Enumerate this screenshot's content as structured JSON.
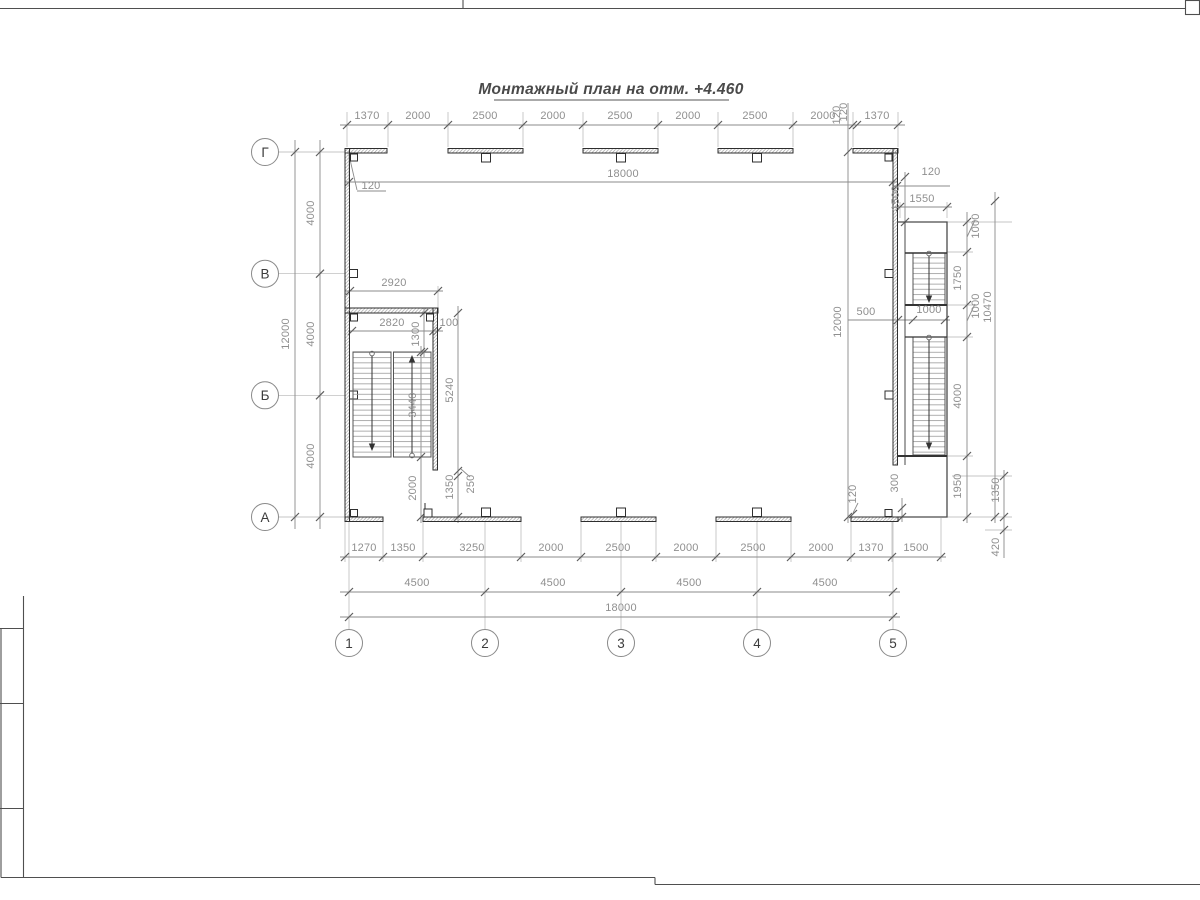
{
  "title": "Монтажный план на отм. +4.460",
  "axes": {
    "left": [
      {
        "label": "Г",
        "x": 265,
        "y": 152
      },
      {
        "label": "В",
        "x": 265,
        "y": 273.7
      },
      {
        "label": "Б",
        "x": 265,
        "y": 395.3
      },
      {
        "label": "А",
        "x": 265,
        "y": 517
      }
    ],
    "bottom": [
      {
        "label": "1",
        "x": 349,
        "y": 643
      },
      {
        "label": "2",
        "x": 485,
        "y": 643
      },
      {
        "label": "3",
        "x": 621,
        "y": 643
      },
      {
        "label": "4",
        "x": 757,
        "y": 643
      },
      {
        "label": "5",
        "x": 893,
        "y": 643
      }
    ]
  },
  "dimensions": {
    "top_chain": [
      "1370",
      "2000",
      "2500",
      "2000",
      "2500",
      "2000",
      "2500",
      "2000",
      "120",
      "1370"
    ],
    "top_overall": "18000",
    "left_chain": [
      "4000",
      "4000",
      "4000"
    ],
    "left_overall": "12000",
    "bottom_chain": [
      "1270",
      "1350",
      "3250",
      "2000",
      "2500",
      "2000",
      "2500",
      "2000",
      "1370",
      "1500"
    ],
    "bottom_spans": [
      "4500",
      "4500",
      "4500",
      "4500"
    ],
    "bottom_overall": "18000",
    "right_chain": [
      "1000",
      "1750",
      "1000",
      "4000",
      "1950"
    ],
    "right_overall": "10470",
    "wall_thickness": "120"
  },
  "labels": [
    {
      "t": "1370",
      "x": 367,
      "y": 119
    },
    {
      "t": "2000",
      "x": 418,
      "y": 119
    },
    {
      "t": "2500",
      "x": 485,
      "y": 119
    },
    {
      "t": "2000",
      "x": 553,
      "y": 119
    },
    {
      "t": "2500",
      "x": 620,
      "y": 119
    },
    {
      "t": "2000",
      "x": 688,
      "y": 119
    },
    {
      "t": "2500",
      "x": 755,
      "y": 119
    },
    {
      "t": "2000",
      "x": 823,
      "y": 119
    },
    {
      "t": "120",
      "x": 847,
      "y": 112,
      "r": -90
    },
    {
      "t": "1370",
      "x": 877,
      "y": 119
    },
    {
      "t": "18000",
      "x": 623,
      "y": 177
    },
    {
      "t": "120",
      "x": 371,
      "y": 189
    },
    {
      "t": "12000",
      "x": 289,
      "y": 334,
      "r": -90
    },
    {
      "t": "4000",
      "x": 314,
      "y": 213,
      "r": -90
    },
    {
      "t": "4000",
      "x": 314,
      "y": 334,
      "r": -90
    },
    {
      "t": "4000",
      "x": 314,
      "y": 456,
      "r": -90
    },
    {
      "t": "2920",
      "x": 394,
      "y": 286
    },
    {
      "t": "2820",
      "x": 392,
      "y": 326
    },
    {
      "t": "100",
      "x": 449,
      "y": 326
    },
    {
      "t": "1300",
      "x": 419,
      "y": 334,
      "r": -90
    },
    {
      "t": "3440",
      "x": 416,
      "y": 405,
      "r": -90
    },
    {
      "t": "5240",
      "x": 453,
      "y": 390,
      "r": -90
    },
    {
      "t": "2000",
      "x": 416,
      "y": 488,
      "r": -90
    },
    {
      "t": "1350",
      "x": 453,
      "y": 487,
      "r": -90
    },
    {
      "t": "250",
      "x": 474,
      "y": 484,
      "r": -90
    },
    {
      "t": "1270",
      "x": 364,
      "y": 551
    },
    {
      "t": "1350",
      "x": 403,
      "y": 551
    },
    {
      "t": "3250",
      "x": 472,
      "y": 551
    },
    {
      "t": "2000",
      "x": 551,
      "y": 551
    },
    {
      "t": "2500",
      "x": 618,
      "y": 551
    },
    {
      "t": "2000",
      "x": 686,
      "y": 551
    },
    {
      "t": "2500",
      "x": 753,
      "y": 551
    },
    {
      "t": "2000",
      "x": 821,
      "y": 551
    },
    {
      "t": "1370",
      "x": 871,
      "y": 551
    },
    {
      "t": "1500",
      "x": 916,
      "y": 551
    },
    {
      "t": "4500",
      "x": 417,
      "y": 586
    },
    {
      "t": "4500",
      "x": 553,
      "y": 586
    },
    {
      "t": "4500",
      "x": 689,
      "y": 586
    },
    {
      "t": "4500",
      "x": 825,
      "y": 586
    },
    {
      "t": "18000",
      "x": 621,
      "y": 611
    },
    {
      "t": "120",
      "x": 840,
      "y": 115,
      "r": -90
    },
    {
      "t": "12000",
      "x": 841,
      "y": 322,
      "r": -90
    },
    {
      "t": "500",
      "x": 866,
      "y": 315
    },
    {
      "t": "1000",
      "x": 929,
      "y": 313
    },
    {
      "t": "120",
      "x": 931,
      "y": 175
    },
    {
      "t": "1500",
      "x": 899,
      "y": 198,
      "r": -90
    },
    {
      "t": "1550",
      "x": 922,
      "y": 202
    },
    {
      "t": "1000",
      "x": 979,
      "y": 226,
      "r": -90
    },
    {
      "t": "1750",
      "x": 961,
      "y": 278,
      "r": -90
    },
    {
      "t": "1000",
      "x": 979,
      "y": 306,
      "r": -90
    },
    {
      "t": "10470",
      "x": 991,
      "y": 307,
      "r": -90
    },
    {
      "t": "4000",
      "x": 961,
      "y": 396,
      "r": -90
    },
    {
      "t": "1950",
      "x": 961,
      "y": 486,
      "r": -90
    },
    {
      "t": "300",
      "x": 898,
      "y": 483,
      "r": -90
    },
    {
      "t": "1350",
      "x": 999,
      "y": 490,
      "r": -90
    },
    {
      "t": "420",
      "x": 999,
      "y": 547,
      "r": -90
    },
    {
      "t": "120",
      "x": 856,
      "y": 494,
      "r": -90
    }
  ]
}
